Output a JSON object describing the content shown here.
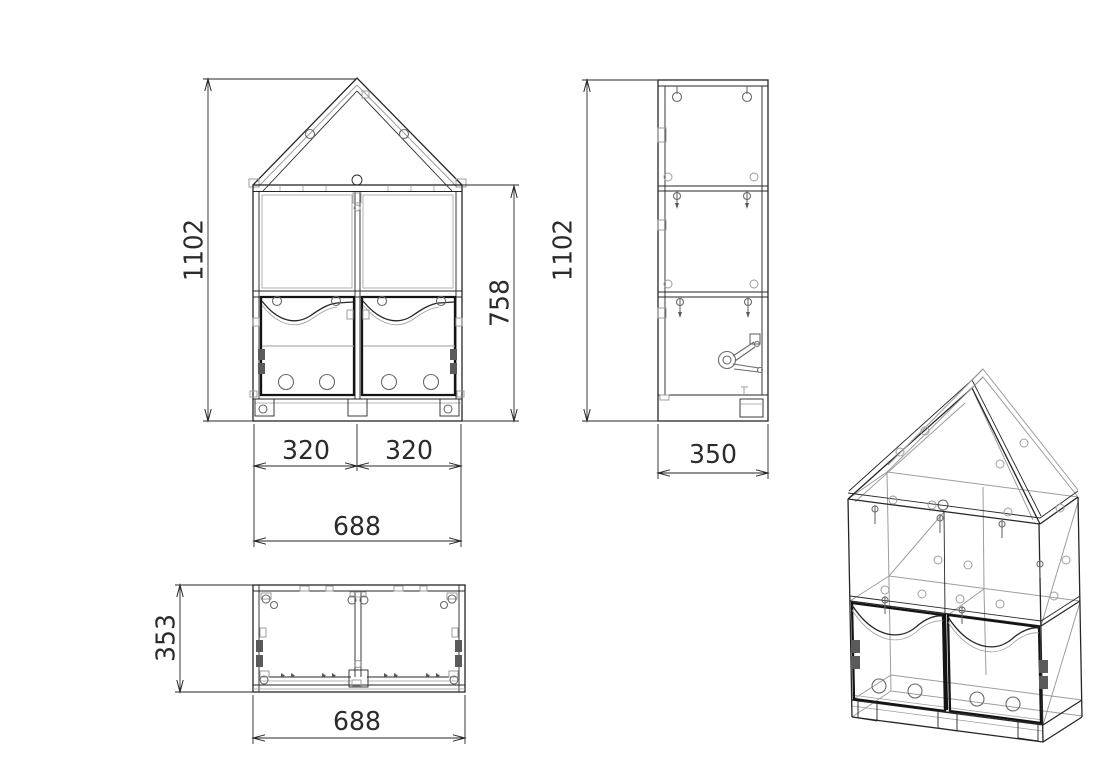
{
  "drawing": {
    "type": "CAD multi-view technical drawing",
    "subject": "house-shaped children's cabinet with two doors",
    "units": "mm",
    "background_color": "#ffffff",
    "main_line_color": "#262626",
    "secondary_line_color": "#9d9d9d",
    "dimension_text_color": "#2b2b2b"
  },
  "views": {
    "front": {
      "label": "front view",
      "dims": {
        "total_height": "1102",
        "body_height": "758",
        "door_width_left": "320",
        "door_width_right": "320",
        "total_width": "688"
      }
    },
    "side": {
      "label": "side view",
      "dims": {
        "total_height": "1102",
        "depth": "350"
      }
    },
    "top": {
      "label": "top view",
      "dims": {
        "depth": "353",
        "total_width": "688"
      }
    },
    "isometric": {
      "label": "isometric view"
    }
  }
}
